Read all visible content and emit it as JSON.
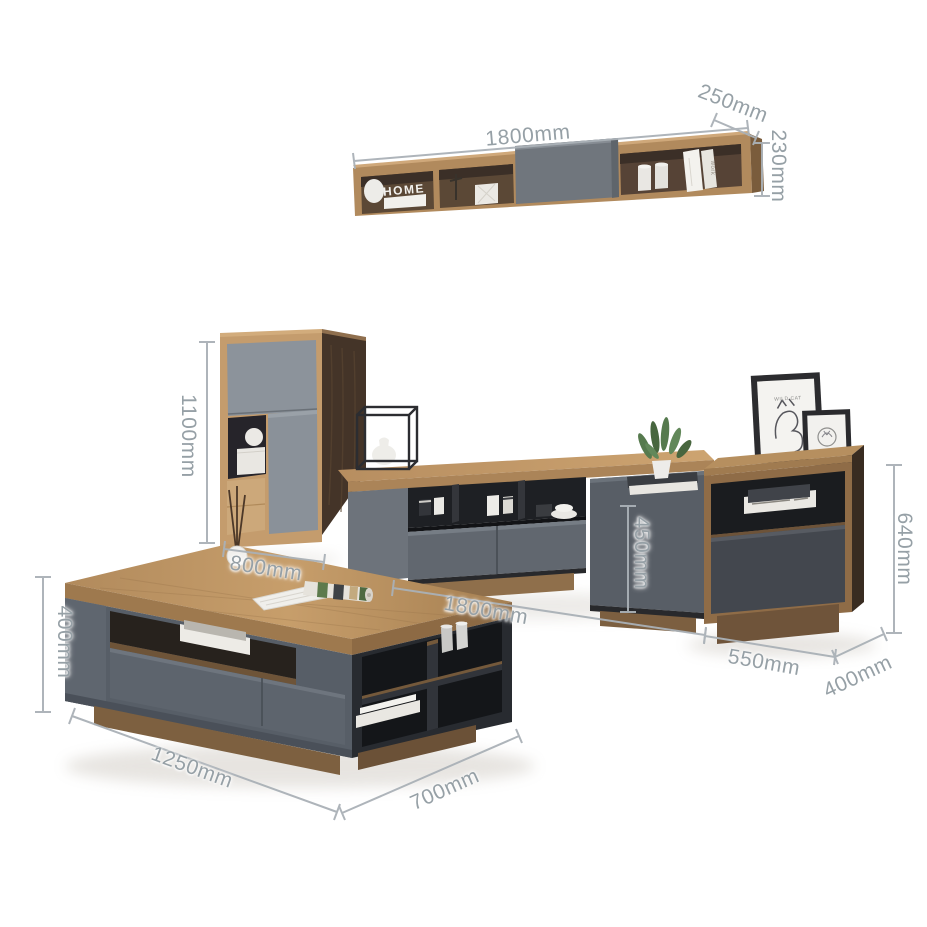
{
  "meta": {
    "type": "furniture-dimension-product-photo",
    "background": "#ffffff",
    "pieces": [
      "wall shelf",
      "tall side cabinet",
      "TV stand",
      "end cabinet",
      "coffee table"
    ]
  },
  "annotations": {
    "style": {
      "text_color": "#96a0a6",
      "line_color": "#aab1b7",
      "font_size_px": 21
    },
    "wall_shelf": {
      "width": "1800mm",
      "depth": "250mm",
      "height": "230mm"
    },
    "tall_cabinet": {
      "height": "1100mm",
      "width": "800mm"
    },
    "tv_stand": {
      "width": "1800mm",
      "height": "450mm"
    },
    "side_cabinet": {
      "height": "640mm",
      "width": "550mm",
      "depth": "400mm"
    },
    "coffee_table": {
      "height": "400mm",
      "width": "1250mm",
      "depth": "700mm"
    }
  },
  "decor": {
    "shelf_letters": "HOME",
    "book_spine_text": "work",
    "frame_caption": "WILD CAT"
  },
  "palette": {
    "wood_light": "#c69d6d",
    "wood_mid": "#b08a5d",
    "wood_dark": "#443428",
    "gray_light": "#8c939b",
    "gray_mid": "#60666e",
    "gray_dark": "#43474e",
    "charcoal": "#26292e"
  }
}
